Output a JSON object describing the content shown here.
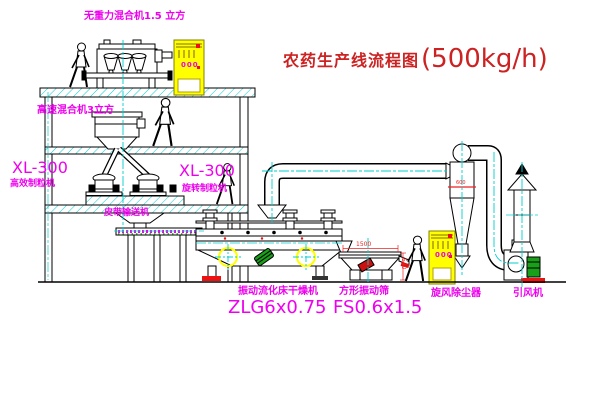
{
  "diagram": {
    "title": "农药生产线流程图",
    "title_capacity": "(500kg/h)"
  },
  "equipment_labels": {
    "top_mixer": "无重力混合机1.5 立方",
    "mid_mixer": "高速混合机3立方",
    "left_granulator_model": "XL-300",
    "left_granulator": "高效制粒机",
    "rotary_granulator_model": "XL-300",
    "rotary_granulator": "旋转制粒机",
    "belt_conveyor": "皮带输送机",
    "fluid_bed_dryer": "振动流化床干燥机",
    "fluid_bed_dryer_model": "ZLG6x0.75",
    "vibrating_screen": "方形振动筛",
    "vibrating_screen_model": "FS0.6x1.5",
    "cyclone": "旋风除尘器",
    "induced_draft_fan": "引风机"
  },
  "dimensions": {
    "screen_length": "1500",
    "screen_height": "540",
    "cyclone_dia": "600"
  },
  "control_cabinet": {
    "display": "000"
  },
  "colors": {
    "label_magenta": "#ee00ee",
    "title_red": "#cc2222",
    "dimension_red": "#ee2222",
    "centerline_cyan": "#00cfcf",
    "highlight_yellow": "#ffff00",
    "motor_green": "#18a018"
  }
}
